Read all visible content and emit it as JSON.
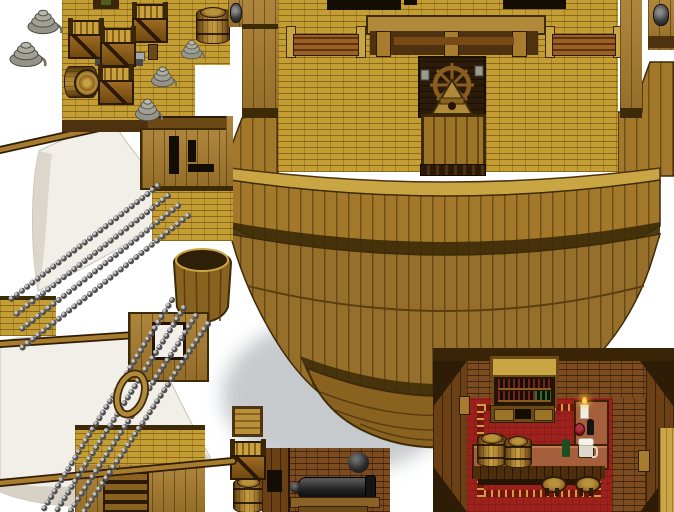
{
  "meta": {
    "scene": "ship-tileset-sprite-sheet",
    "background": "#ffffff"
  },
  "palette": {
    "deck_yellow": "#c49d33",
    "deck_mortar": "#8f6d1d",
    "wood_dark": "#4e3210",
    "wood_mid": "#8a6220",
    "wood_light": "#c9a643",
    "hull_brown": "#a3782a",
    "hull_lower": "#96702a",
    "keel": "#8a6220",
    "sail_white": "#f2eee8",
    "sail_shade": "#d8d1c6",
    "chain_light": "#c2c2c2",
    "chain_dark": "#4f4f4f",
    "metal_gray": "#9a9a8e",
    "tavern_wall": "#6b4015",
    "tavern_brick": "#7c4b20",
    "carpet_red": "#9e211c",
    "carpet_border_gold": "#caa03c",
    "counter_tan": "#a55f3c",
    "cannon_black": "#1c1c1c",
    "barrel_brown": "#9c7428",
    "rope_gray": "#a0a096"
  },
  "regions": {
    "top_left_rope_pile": {
      "label": "loose rope coil sprites on white"
    },
    "cargo_deck": {
      "label": "ship deck with open crates, barrels, rope coils and bench"
    },
    "rigging": {
      "label": "mast housings, white sails, chain shrouds, hoop and crow's nest"
    },
    "main_ship": {
      "label": "large ship hull seen from above with railings, helm emblem and door"
    },
    "item_sprites": {
      "label": "crate top, open crate and barrel sprites"
    },
    "gun_deck": {
      "label": "interior wall with black cannon and cannonball"
    },
    "tavern": {
      "label": "tavern interior with wine rack, L-shaped bar, barrels and stools"
    }
  },
  "sprites": {
    "rope_coils": [
      {
        "x": 26,
        "y": 7,
        "w": 38,
        "h": 28
      },
      {
        "x": 8,
        "y": 39,
        "w": 40,
        "h": 29
      },
      {
        "x": 180,
        "y": 38,
        "w": 26,
        "h": 22
      },
      {
        "x": 150,
        "y": 64,
        "w": 28,
        "h": 24
      },
      {
        "x": 134,
        "y": 96,
        "w": 30,
        "h": 26
      }
    ],
    "open_crates": [
      {
        "x": 132,
        "y": 4
      },
      {
        "x": 68,
        "y": 20
      },
      {
        "x": 100,
        "y": 28
      },
      {
        "x": 98,
        "y": 66
      },
      {
        "x": 230,
        "y": 441
      }
    ],
    "chains": {
      "upper": [
        [
          158,
          186,
          10,
          300
        ],
        [
          168,
          196,
          14,
          316
        ],
        [
          178,
          206,
          18,
          332
        ],
        [
          188,
          216,
          22,
          348
        ]
      ],
      "lower": [
        [
          172,
          300,
          42,
          512
        ],
        [
          184,
          308,
          56,
          512
        ],
        [
          196,
          316,
          70,
          512
        ],
        [
          208,
          324,
          84,
          512
        ]
      ]
    },
    "spars_back": [
      [
        0,
        150,
        162,
        114
      ],
      [
        0,
        344,
        150,
        334
      ]
    ],
    "spars_front": [
      [
        0,
        483,
        233,
        461
      ]
    ]
  }
}
